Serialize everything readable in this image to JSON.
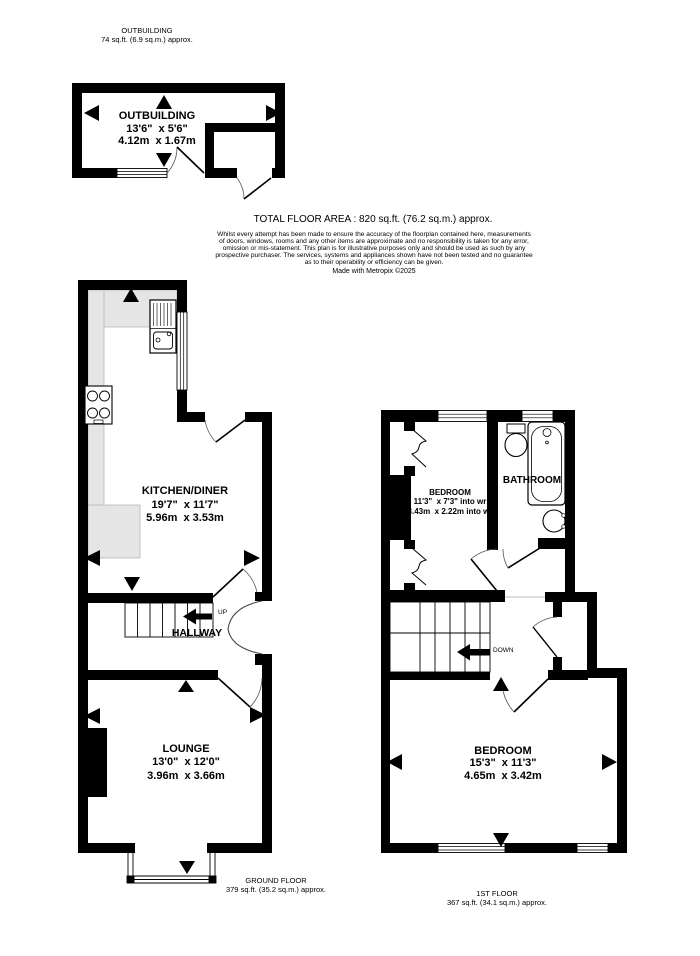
{
  "header": {
    "title": "OUTBUILDING",
    "area": "74 sq.ft. (6.9 sq.m.) approx."
  },
  "summary": {
    "total": "TOTAL FLOOR AREA : 820 sq.ft. (76.2 sq.m.) approx.",
    "lines": [
      "Whilst every attempt has been made to ensure the accuracy of the floorplan contained here, measurements",
      "of doors, windows, rooms and any other items are approximate and no responsibility is taken for any error,",
      "omission or mis-statement. This plan is for illustrative purposes only and should be used as such by any",
      "prospective purchaser. The services, systems and appliances shown have not been tested and no guarantee",
      "as to their operability or efficiency can be given."
    ],
    "credit": "Made with Metropix ©2025"
  },
  "rooms": {
    "outbuilding": {
      "name": "OUTBUILDING",
      "imperial": "13'6\"  x 5'6\"",
      "metric": "4.12m  x 1.67m"
    },
    "kitchen": {
      "name": "KITCHEN/DINER",
      "imperial": "19'7\"  x 11'7\"",
      "metric": "5.96m  x 3.53m"
    },
    "hallway": {
      "name": "HALLWAY"
    },
    "lounge": {
      "name": "LOUNGE",
      "imperial": "13'0\"  x 12'0\"",
      "metric": "3.96m  x 3.66m"
    },
    "bedroom1": {
      "name": "BEDROOM",
      "imperial": "11'3\"  x 7'3\" into wr",
      "metric": "3.43m  x 2.22m into wr"
    },
    "bathroom": {
      "name": "BATHROOM"
    },
    "bedroom2": {
      "name": "BEDROOM",
      "imperial": "15'3\"  x 11'3\"",
      "metric": "4.65m  x 3.42m"
    }
  },
  "stairs": {
    "up": "UP",
    "down": "DOWN"
  },
  "floors": {
    "ground": {
      "title": "GROUND FLOOR",
      "area": "379 sq.ft. (35.2 sq.m.) approx."
    },
    "first": {
      "title": "1ST FLOOR",
      "area": "367 sq.ft. (34.1 sq.m.) approx."
    }
  },
  "colors": {
    "wall": "#000000",
    "counter": "#e5e5e5",
    "background": "#ffffff"
  }
}
